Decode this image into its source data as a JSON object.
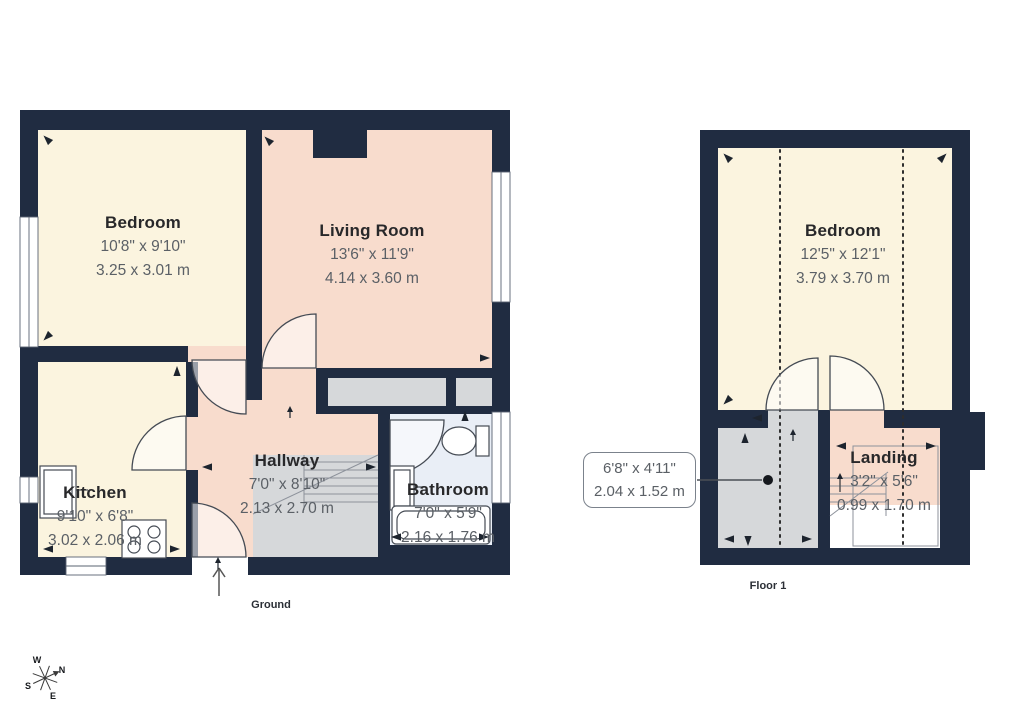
{
  "ground": {
    "caption": "Ground",
    "rooms": [
      {
        "name": "Bedroom",
        "dims_imperial": "10'8\" x 9'10\"",
        "dims_metric": "3.25 x 3.01 m"
      },
      {
        "name": "Living Room",
        "dims_imperial": "13'6\" x 11'9\"",
        "dims_metric": "4.14 x 3.60 m"
      },
      {
        "name": "Kitchen",
        "dims_imperial": "9'10\" x 6'8\"",
        "dims_metric": "3.02 x 2.06 m"
      },
      {
        "name": "Hallway",
        "dims_imperial": "7'0\" x 8'10\"",
        "dims_metric": "2.13 x 2.70 m"
      },
      {
        "name": "Bathroom",
        "dims_imperial": "7'0\" x 5'9\"",
        "dims_metric": "2.16 x 1.76 m"
      }
    ]
  },
  "floor1": {
    "caption": "Floor 1",
    "rooms": [
      {
        "name": "Bedroom",
        "dims_imperial": "12'5\" x 12'1\"",
        "dims_metric": "3.79 x 3.70 m"
      },
      {
        "name": "Landing",
        "dims_imperial": "3'2\" x 5'6\"",
        "dims_metric": "0.99 x 1.70 m"
      }
    ],
    "callout": {
      "dims_imperial": "6'8\" x 4'11\"",
      "dims_metric": "2.04 x 1.52 m"
    }
  },
  "compass": {
    "n": "N",
    "e": "E",
    "s": "S",
    "w": "W"
  },
  "colors": {
    "wall": "#202c41",
    "cream": "#fbf4df",
    "pink": "#f8dccd",
    "blue": "#e9eef6",
    "grey": "#d6d8da",
    "line": "#454b54",
    "nameText": "#28282a",
    "dimText": "#5b6066"
  }
}
